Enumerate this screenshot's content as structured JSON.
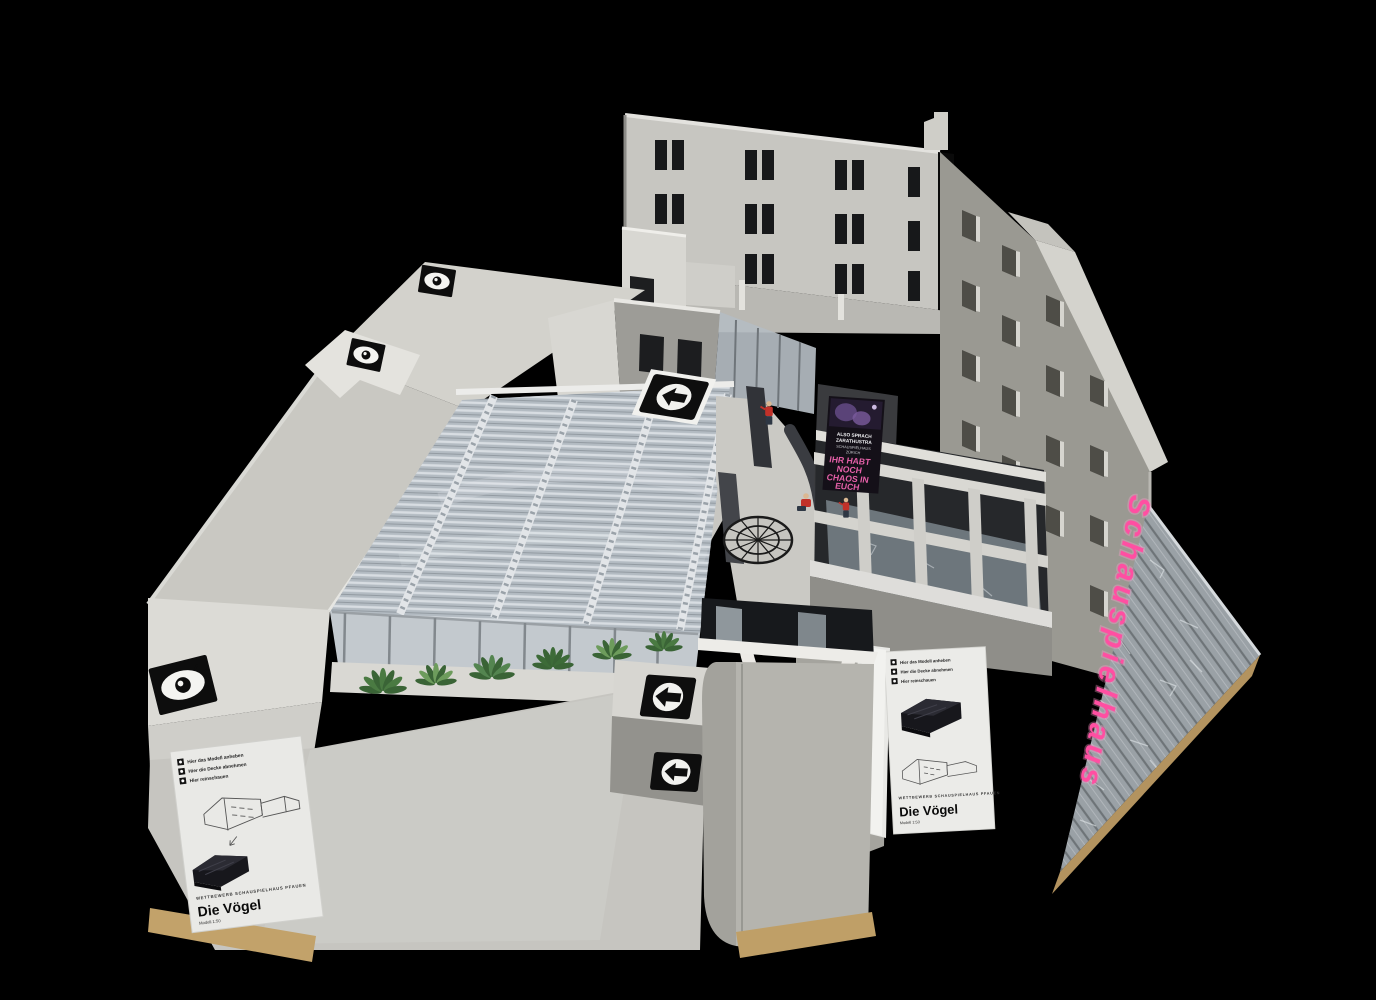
{
  "infosheets": {
    "left": {
      "instructions": [
        "Hier das Modell anheben",
        "Hier die Decke abnehmen",
        "Hier reinschauen"
      ],
      "competition": "WETTBEWERB SCHAUSPIELHAUS PFAUEN",
      "title": "Die Vögel",
      "scale": "Modell 1:50"
    },
    "right": {
      "instructions": [
        "Hier das Modell anheben",
        "Hier die Decke abnehmen",
        "Hier reinschauen"
      ],
      "competition": "WETTBEWERB SCHAUSPIELHAUS PFAUEN",
      "title": "Die Vögel",
      "scale": "Modell 1:50"
    }
  },
  "poster": {
    "small_lines": [
      "ALSO SPRACH",
      "ZARATHUSTRA",
      "SCHAUSPIELHAUS",
      "ZÜRICH"
    ],
    "headline_lines": [
      "IHR HABT",
      "NOCH",
      "CHAOS IN",
      "EUCH"
    ]
  },
  "neon_sign": {
    "text": "Schauspielhaus",
    "color": "#ff4fa2"
  },
  "icons": {
    "eye": "eye-icon",
    "arrow_left": "arrow-left-icon"
  },
  "colors": {
    "background": "#000000",
    "concrete_light": "#cecdc7",
    "concrete_mid": "#a8a7a1",
    "glass": "#b6bec5",
    "mdf_wood": "#bf9f67",
    "figure_red": "#c13129",
    "plant_green": "#5d8f54",
    "neon_pink": "#ff4fa2"
  }
}
